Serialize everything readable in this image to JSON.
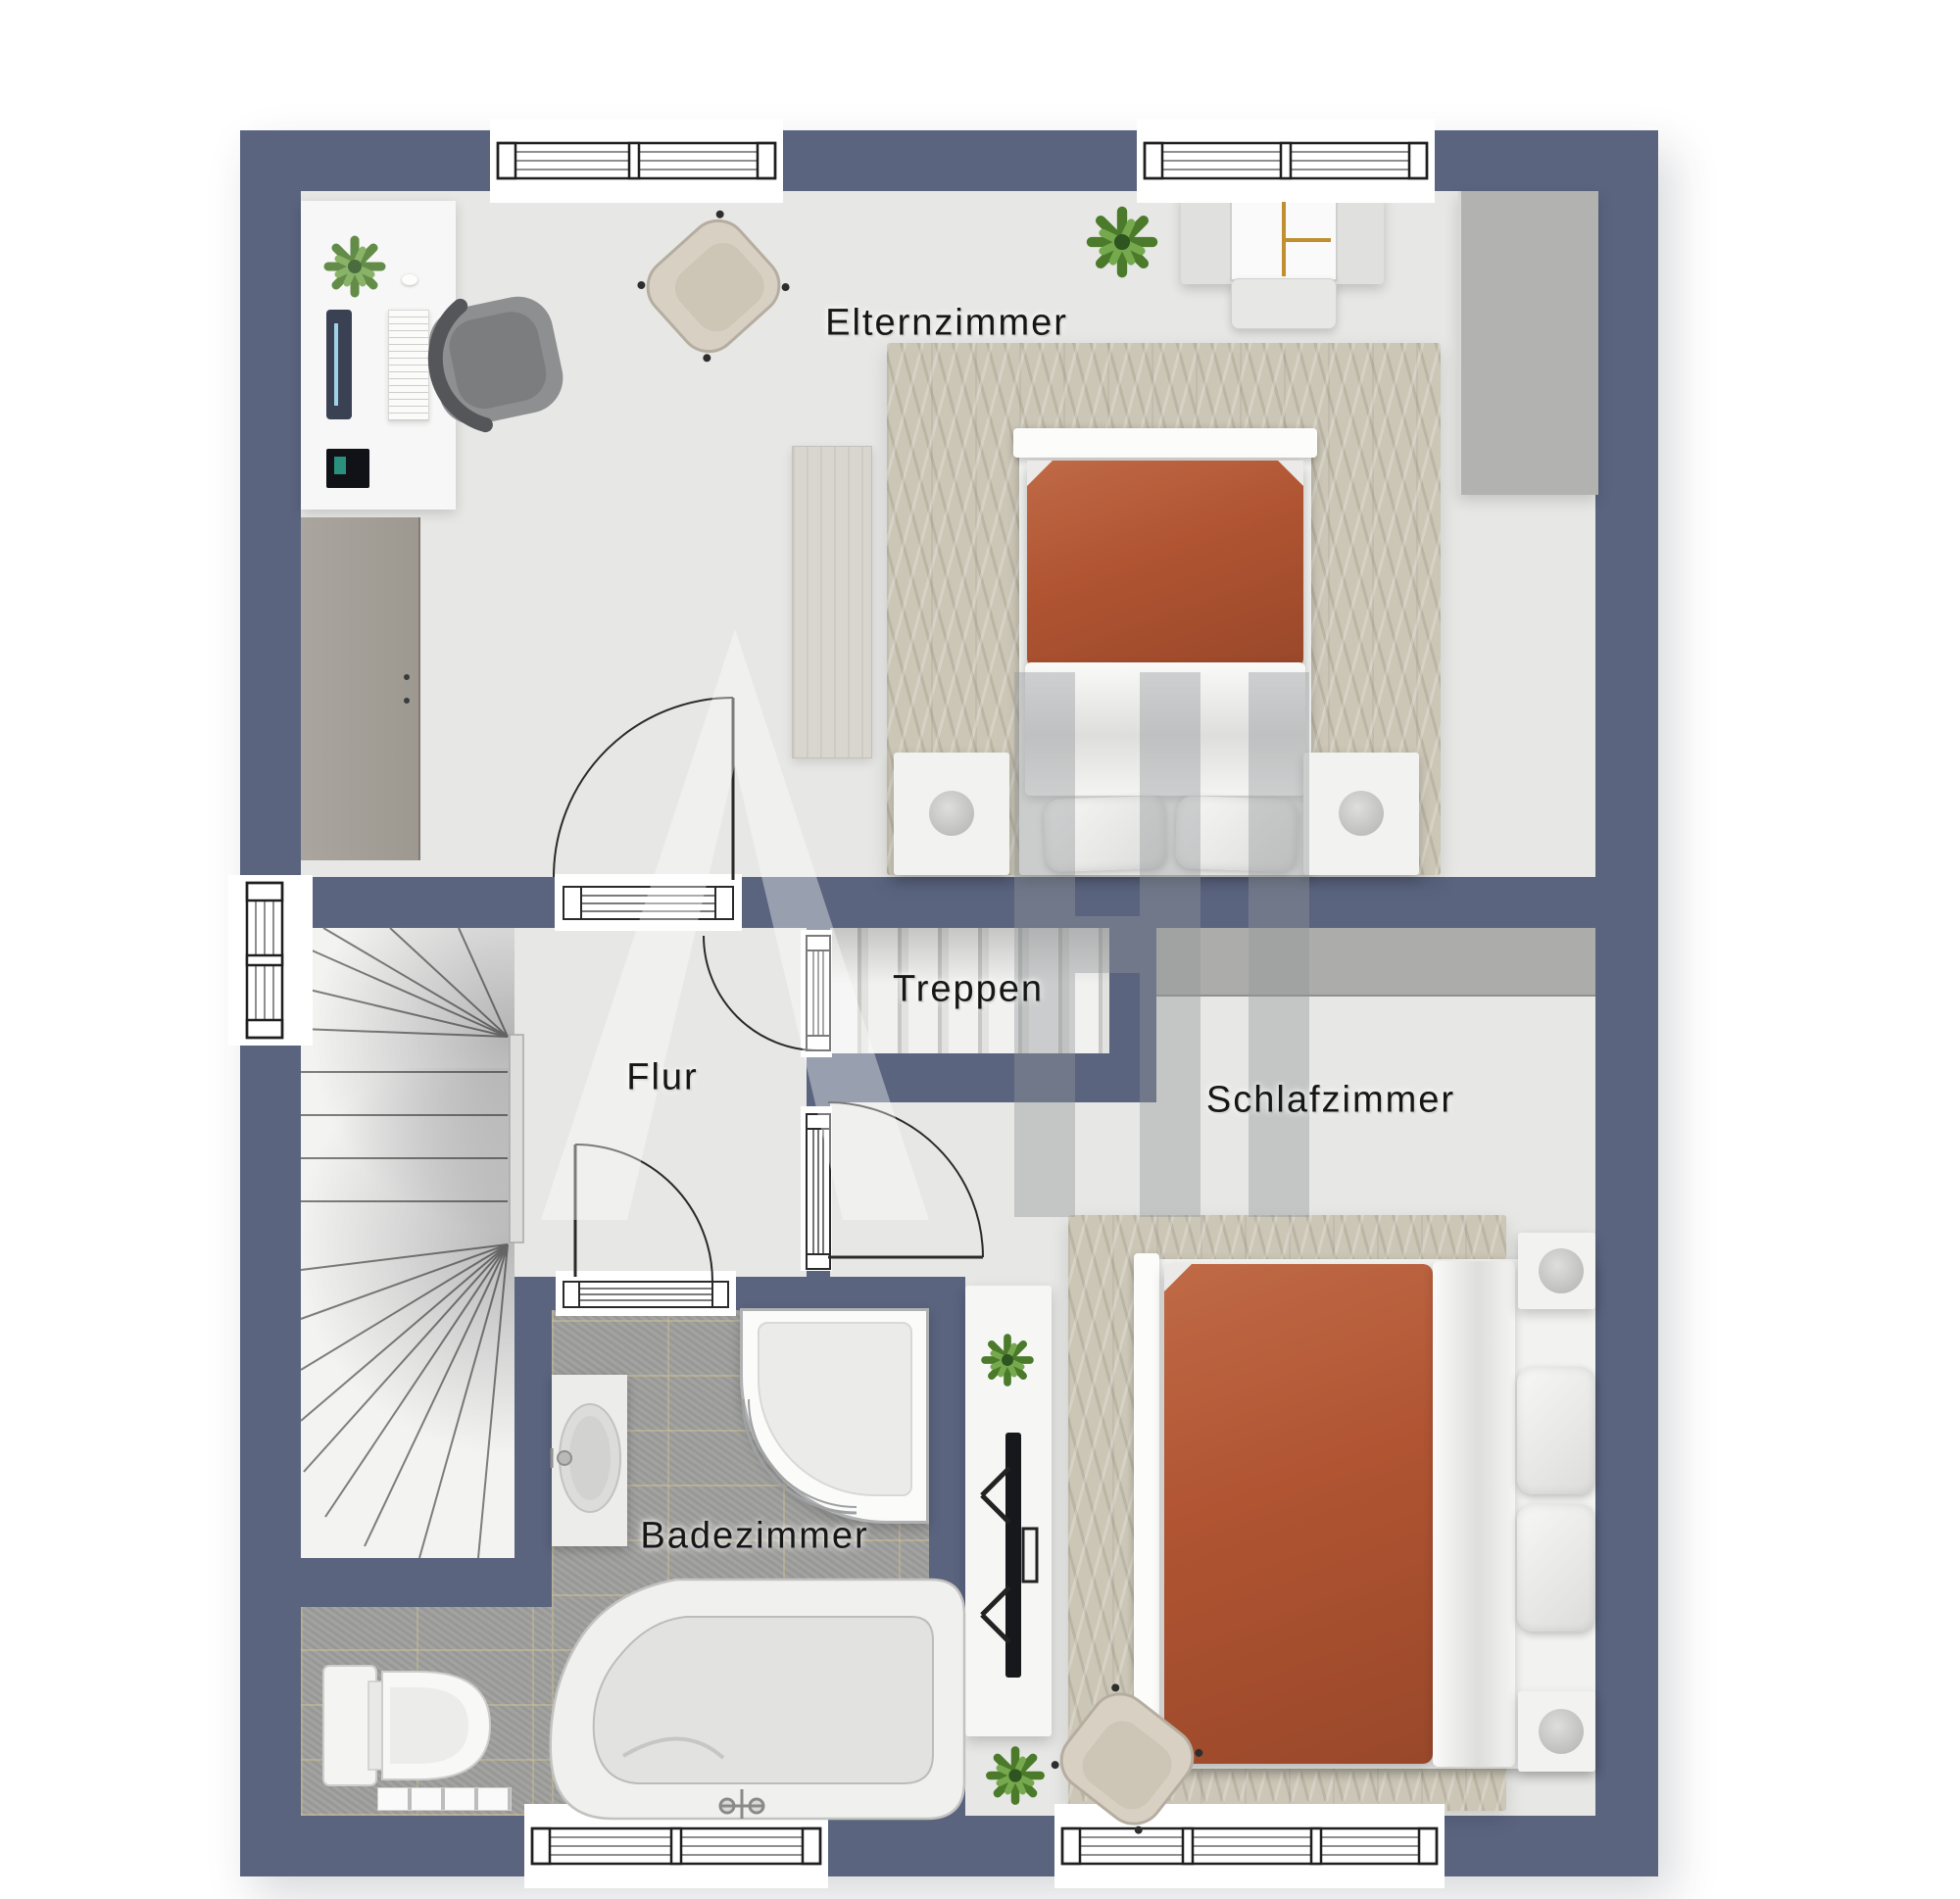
{
  "watermark": {
    "text": "AHI",
    "symbol": "triangle-A-logo"
  },
  "rooms": {
    "elternzimmer": {
      "label": "Elternzimmer"
    },
    "treppen": {
      "label": "Treppen"
    },
    "flur": {
      "label": "Flur"
    },
    "schlafzimmer": {
      "label": "Schlafzimmer"
    },
    "badezimmer": {
      "label": "Badezimmer"
    }
  },
  "colors": {
    "wall": "#5a647f",
    "floor": "#e7e7e5",
    "tile": "#9e9e9c",
    "grout": "#cdbf93",
    "stair": "#f3f3f2",
    "rug": "#cbc6b6",
    "duvet": "#b05432",
    "duvet-dark": "#99482a",
    "wardrobe": "#acacaa",
    "wood": "#d9d5cf",
    "sideboard": "#a6a19b",
    "label": "#161616"
  }
}
